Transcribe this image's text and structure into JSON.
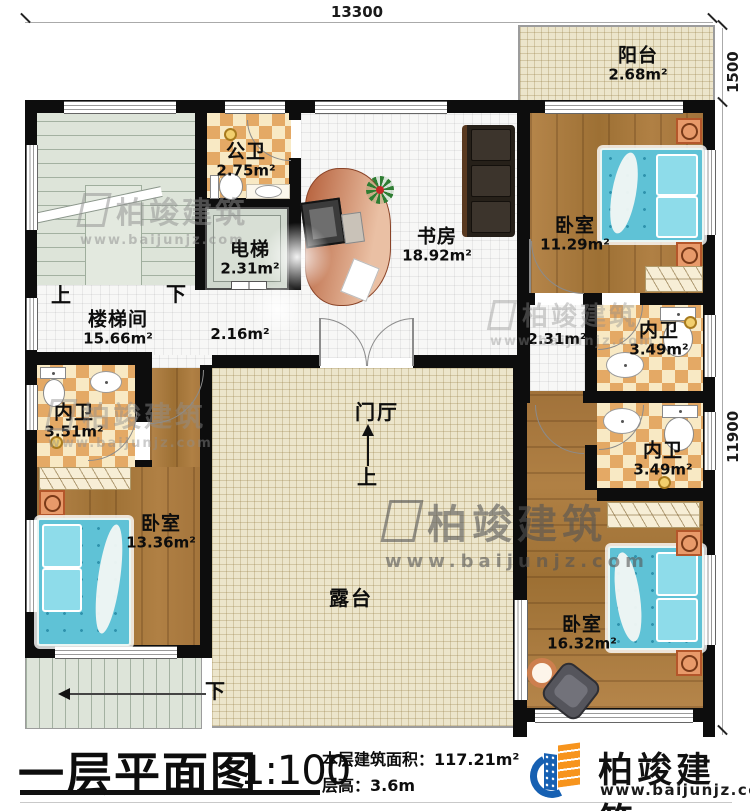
{
  "dimensions": {
    "width_top": "13300",
    "balcony_depth": "1500",
    "height_right": "11900"
  },
  "rooms": {
    "balcony": {
      "name": "阳台",
      "area": "2.68m²"
    },
    "public_bath": {
      "name": "公卫",
      "area": "2.75m²"
    },
    "elevator": {
      "name": "电梯",
      "area": "2.31m²"
    },
    "study": {
      "name": "书房",
      "area": "18.92m²"
    },
    "bedroom_tr": {
      "name": "卧室",
      "area": "11.29m²"
    },
    "stairwell": {
      "name": "楼梯间",
      "area": "15.66m²"
    },
    "hall_left": {
      "area": "2.16m²"
    },
    "hall_right": {
      "area": "2.31m²"
    },
    "bath_tr": {
      "name": "内卫",
      "area": "3.49m²"
    },
    "bath_left": {
      "name": "内卫",
      "area": "3.51m²"
    },
    "bedroom_left": {
      "name": "卧室",
      "area": "13.36m²"
    },
    "foyer": {
      "name": "门厅"
    },
    "terrace": {
      "name": "露台"
    },
    "bath_br": {
      "name": "内卫",
      "area": "3.49m²"
    },
    "bedroom_br": {
      "name": "卧室",
      "area": "16.32m²"
    }
  },
  "stairs": {
    "up": "上",
    "down": "下"
  },
  "title_block": {
    "title": "一层平面图",
    "scale": "1:100",
    "area_label": "本层建筑面积：",
    "area_value": "117.21m²",
    "floor_height": "层高：3.6m"
  },
  "brand": {
    "name": "柏竣建筑",
    "website": "www.baijunjz.com"
  },
  "colors": {
    "wall": "#0d0d0d",
    "wood": "#a9783c",
    "check_dark": "#e4a965",
    "check_light": "#f8e9c4",
    "bed": "#5fc2d6",
    "cream": "#ece5cb",
    "logo_blue": "#1660b2",
    "logo_orange": "#f7941d"
  }
}
